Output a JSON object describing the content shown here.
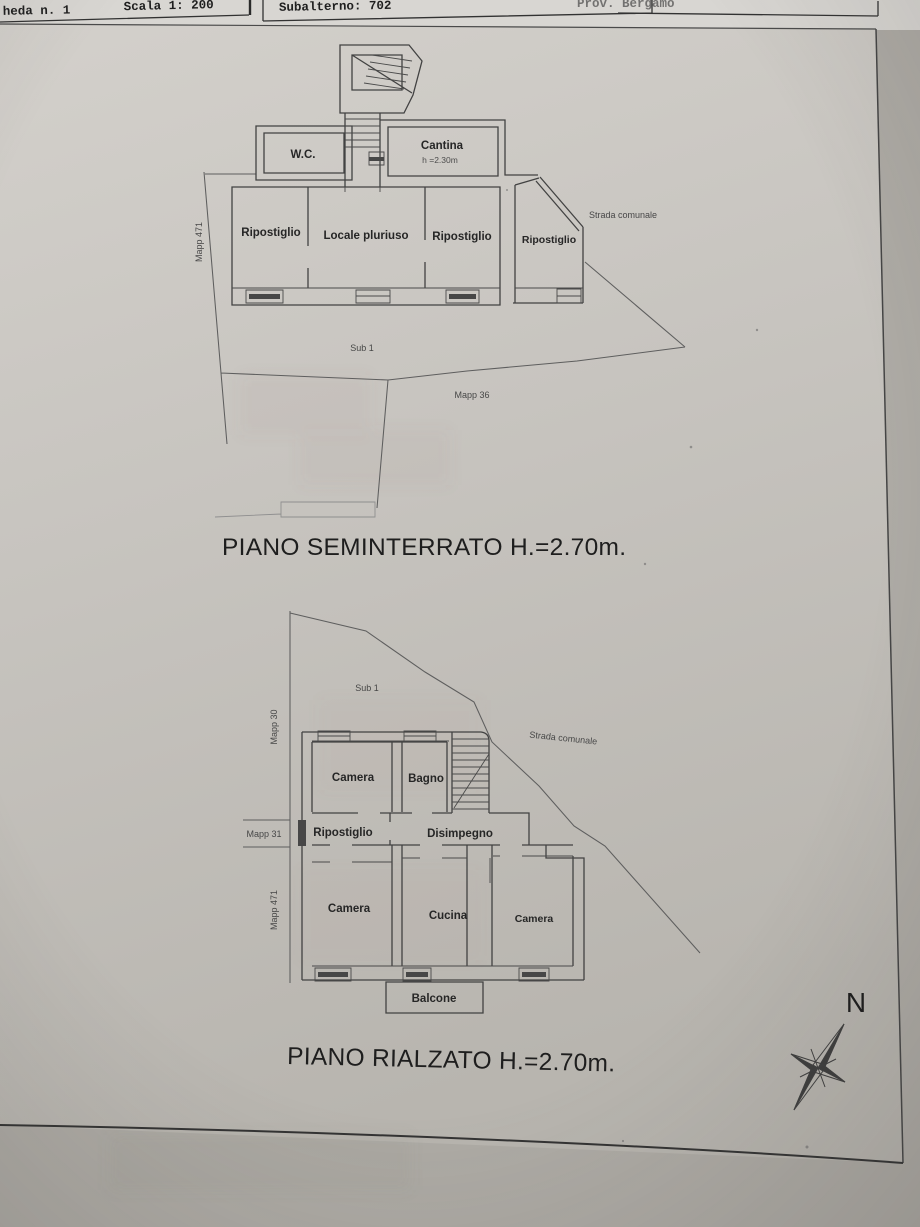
{
  "header": {
    "sheet_label": "heda n. 1",
    "scale_label": "Scala 1: 200",
    "subalterno_label": "Subalterno: 702",
    "province_label": "Prov. Bergamo"
  },
  "plans": {
    "seminterrato": {
      "title": "PIANO SEMINTERRATO H.=2.70m.",
      "rooms": {
        "wc": "W.C.",
        "cantina": "Cantina",
        "cantina_note": "h =2.30m",
        "ripostiglio_1": "Ripostiglio",
        "locale_pluriuso": "Locale pluriuso",
        "ripostiglio_2": "Ripostiglio",
        "ripostiglio_3": "Ripostiglio"
      },
      "annotations": {
        "mapp_471": "Mapp 471",
        "sub_1": "Sub 1",
        "mapp_36": "Mapp 36",
        "strada_comunale": "Strada comunale"
      }
    },
    "rialzato": {
      "title": "PIANO RIALZATO H.=2.70m.",
      "rooms": {
        "camera_1": "Camera",
        "bagno": "Bagno",
        "ripostiglio": "Ripostiglio",
        "disimpegno": "Disimpegno",
        "camera_2": "Camera",
        "cucina": "Cucina",
        "camera_3": "Camera",
        "balcone": "Balcone"
      },
      "annotations": {
        "mapp_30": "Mapp 30",
        "mapp_31": "Mapp 31",
        "mapp_471": "Mapp 471",
        "sub_1": "Sub 1",
        "strada_comunale": "Strada comunale"
      }
    }
  },
  "compass": {
    "north": "N"
  },
  "colors": {
    "paper": "#c8c5c0",
    "ink": "#3c3c3c",
    "boundary_line": "#5e5e5e"
  }
}
